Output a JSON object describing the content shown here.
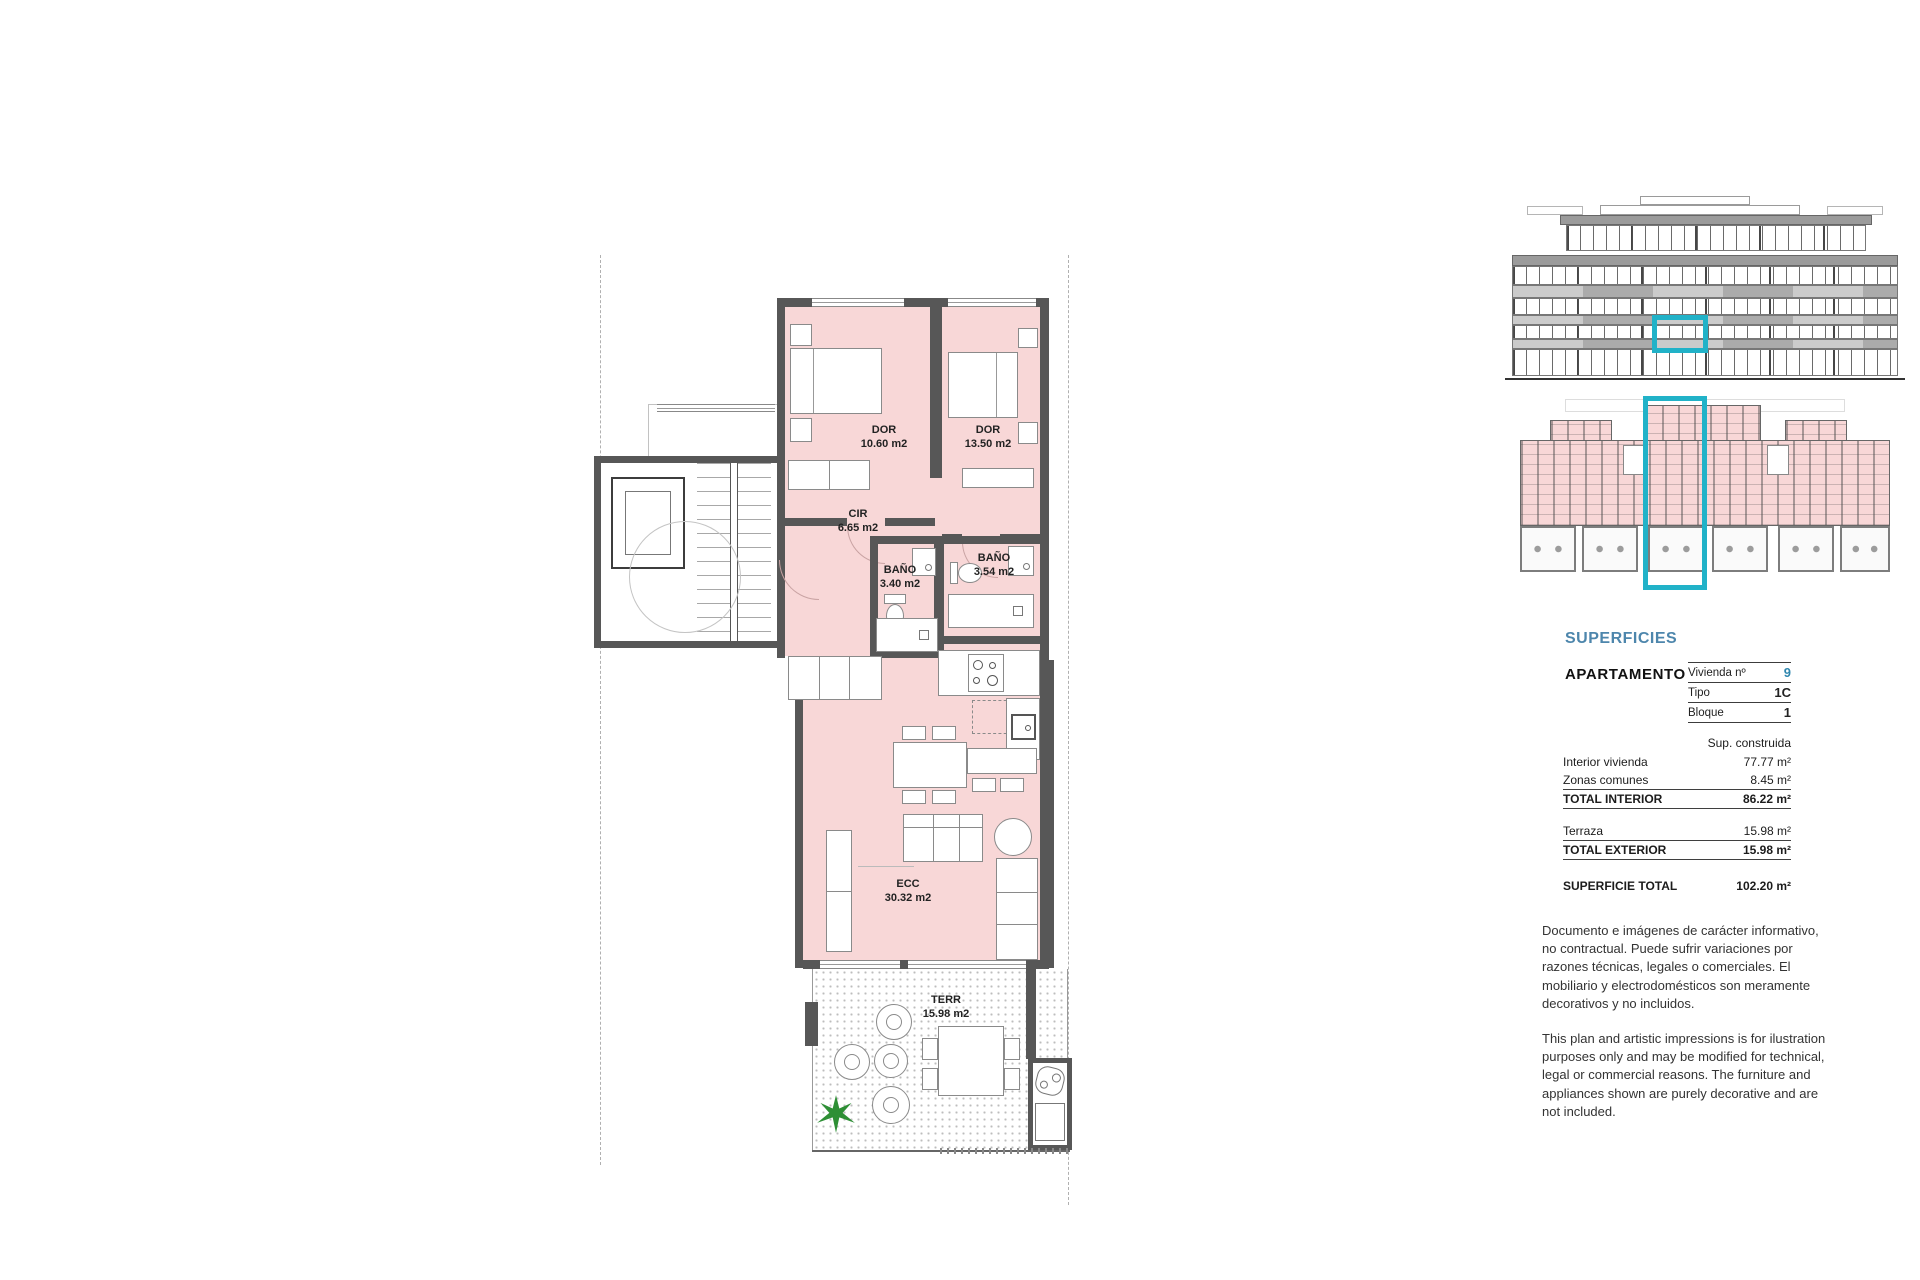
{
  "plan": {
    "rooms": {
      "dor1": {
        "name": "DOR",
        "area": "10.60 m2"
      },
      "dor2": {
        "name": "DOR",
        "area": "13.50 m2"
      },
      "cir": {
        "name": "CIR",
        "area": "6.65 m2"
      },
      "bano1": {
        "name": "BAÑO",
        "area": "3.40 m2"
      },
      "bano2": {
        "name": "BAÑO",
        "area": "3.54 m2"
      },
      "ecc": {
        "name": "ECC",
        "area": "30.32 m2"
      },
      "terr": {
        "name": "TERR",
        "area": "15.98 m2"
      }
    }
  },
  "sidebar": {
    "section_title": "SUPERFICIES",
    "apartment_label": "APARTAMENTO",
    "unit_table": {
      "rows": [
        {
          "label": "Vivienda nº",
          "value": "9"
        },
        {
          "label": "Tipo",
          "value": "1C"
        },
        {
          "label": "Bloque",
          "value": "1"
        }
      ]
    },
    "surface_table": {
      "header": "Sup. construida",
      "rows": [
        {
          "label": "Interior vivienda",
          "value": "77.77 m²"
        },
        {
          "label": "Zonas comunes",
          "value": "8.45 m²"
        },
        {
          "label": "TOTAL INTERIOR",
          "value": "86.22 m²"
        },
        {
          "label": "Terraza",
          "value": "15.98 m²"
        },
        {
          "label": "TOTAL EXTERIOR",
          "value": "15.98 m²"
        }
      ],
      "total_label": "SUPERFICIE TOTAL",
      "total_value": "102.20 m²"
    },
    "disclaimer_es": "Documento e imágenes de carácter informativo, no contractual. Puede sufrir variaciones por razones técnicas, legales o comerciales. El mobiliario y electrodomésticos son meramente decorativos y no incluidos.",
    "disclaimer_en": "This plan and artistic impressions is for ilustration purposes only and may be modified for technical, legal or commercial reasons. The furniture and appliances shown are purely decorative and are not included."
  },
  "colors": {
    "pink": "#f8d7d7",
    "wall": "#575757",
    "cyan": "#21b2c8",
    "blue": "#4d86ac",
    "accent": "#2e86ae",
    "plant": "#2e8f35"
  }
}
